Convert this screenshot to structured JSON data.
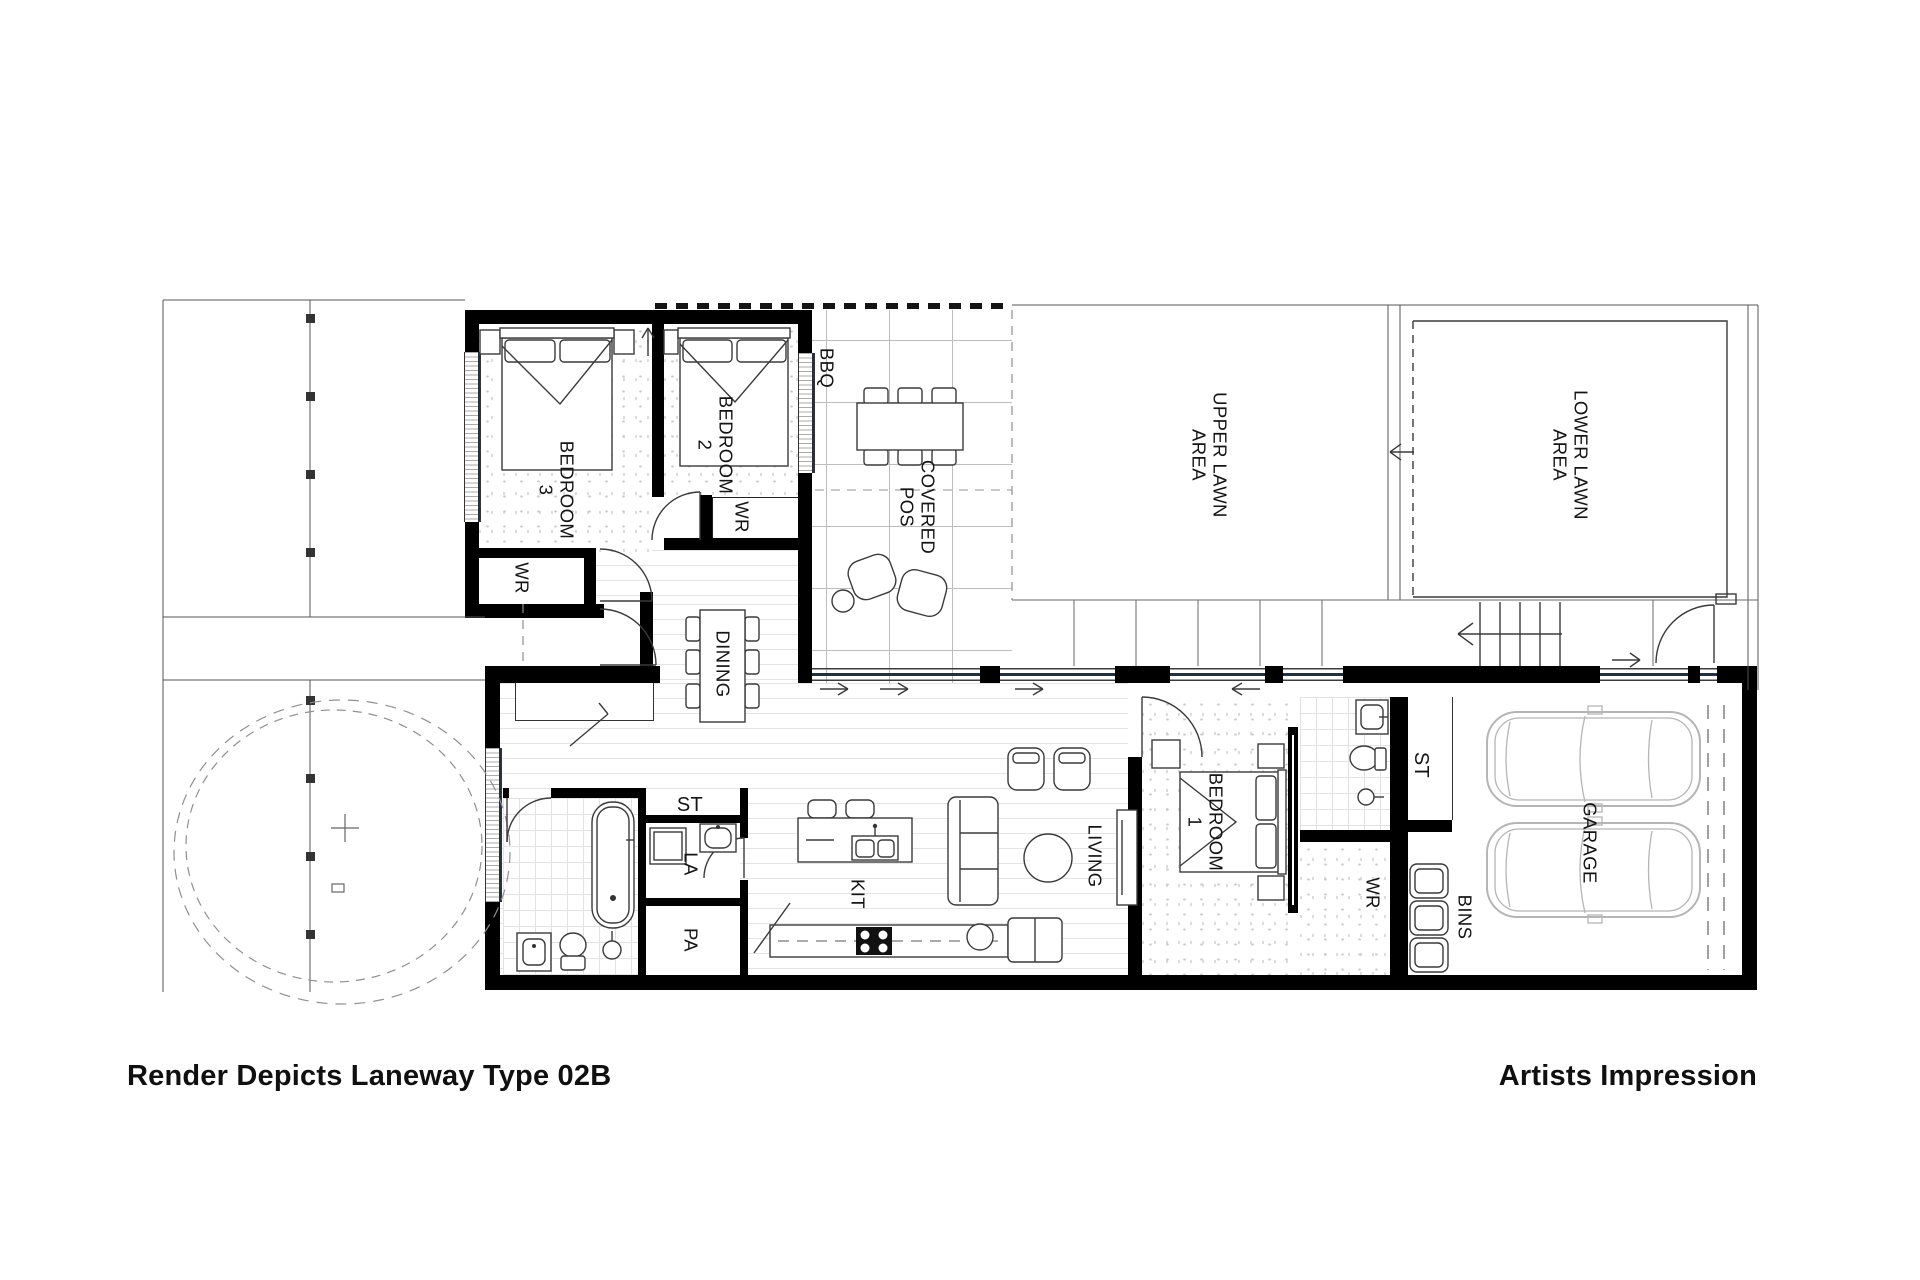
{
  "plan": {
    "title_type": "architectural floor plan",
    "labels": {
      "bedroom3": "BEDROOM\n3",
      "bedroom2": "BEDROOM\n2",
      "bedroom1": "BEDROOM\n1",
      "wr_bedroom3": "WR",
      "wr_bedroom2": "WR",
      "wr_bedroom1": "WR",
      "bbq": "BBQ",
      "covered_pos": "COVERED\nPOS",
      "upper_lawn": "UPPER LAWN\nAREA",
      "lower_lawn": "LOWER LAWN\nAREA",
      "dining": "DINING",
      "store_hall": "ST",
      "laundry": "LA",
      "pantry": "PA",
      "kitchen": "KIT",
      "living": "LIVING",
      "store_garage": "ST",
      "bins": "BINS",
      "garage": "GARAGE"
    }
  },
  "footer": {
    "left_caption": "Render Depicts Laneway Type 02B",
    "right_caption": "Artists Impression"
  },
  "colors": {
    "wall": "#000000",
    "line": "#3a3a3a",
    "grid": "#bdbdbd",
    "brick": "#e4e4e4",
    "speck": "#c9c9c9",
    "glazing": "#25303e",
    "car": "#b5b5b5",
    "dashed": "#909090"
  }
}
